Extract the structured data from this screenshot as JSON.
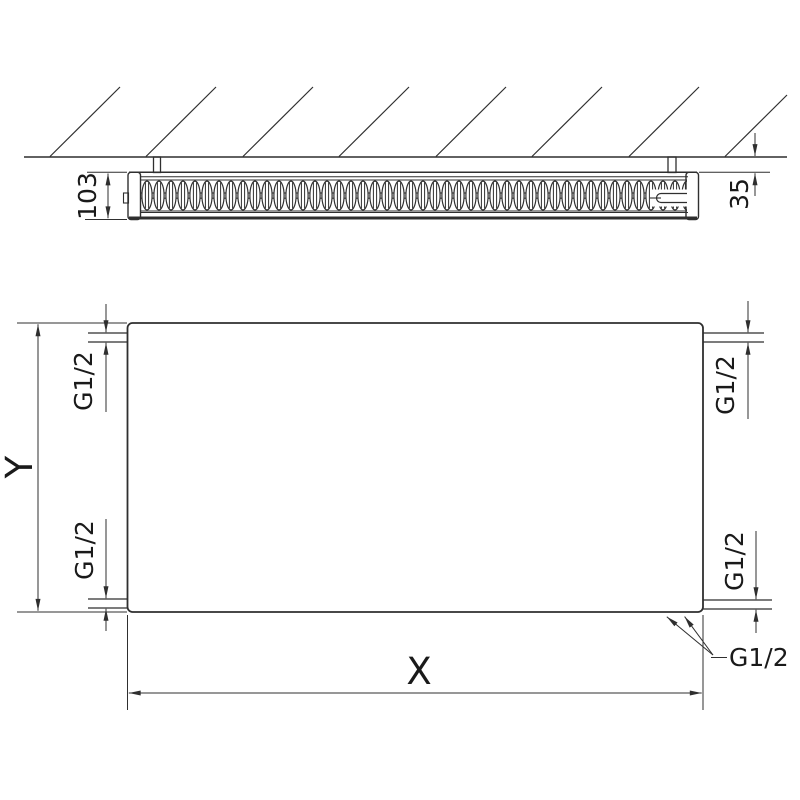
{
  "drawing": {
    "type": "radiator-technical-dimension-drawing",
    "views": [
      "top-section-view-at-wall",
      "front-view"
    ],
    "labels": {
      "depth": "103",
      "wall_distance": "35",
      "height": "Y",
      "width": "X",
      "port_top_left": "G1/2",
      "port_top_right": "G1/2",
      "port_bottom_left": "G1/2",
      "port_bottom_right": "G1/2",
      "bottom_connection": "G1/2"
    },
    "colors": {
      "line": "#2f2f2f",
      "text": "#1a1a1a",
      "background": "#ffffff"
    }
  }
}
